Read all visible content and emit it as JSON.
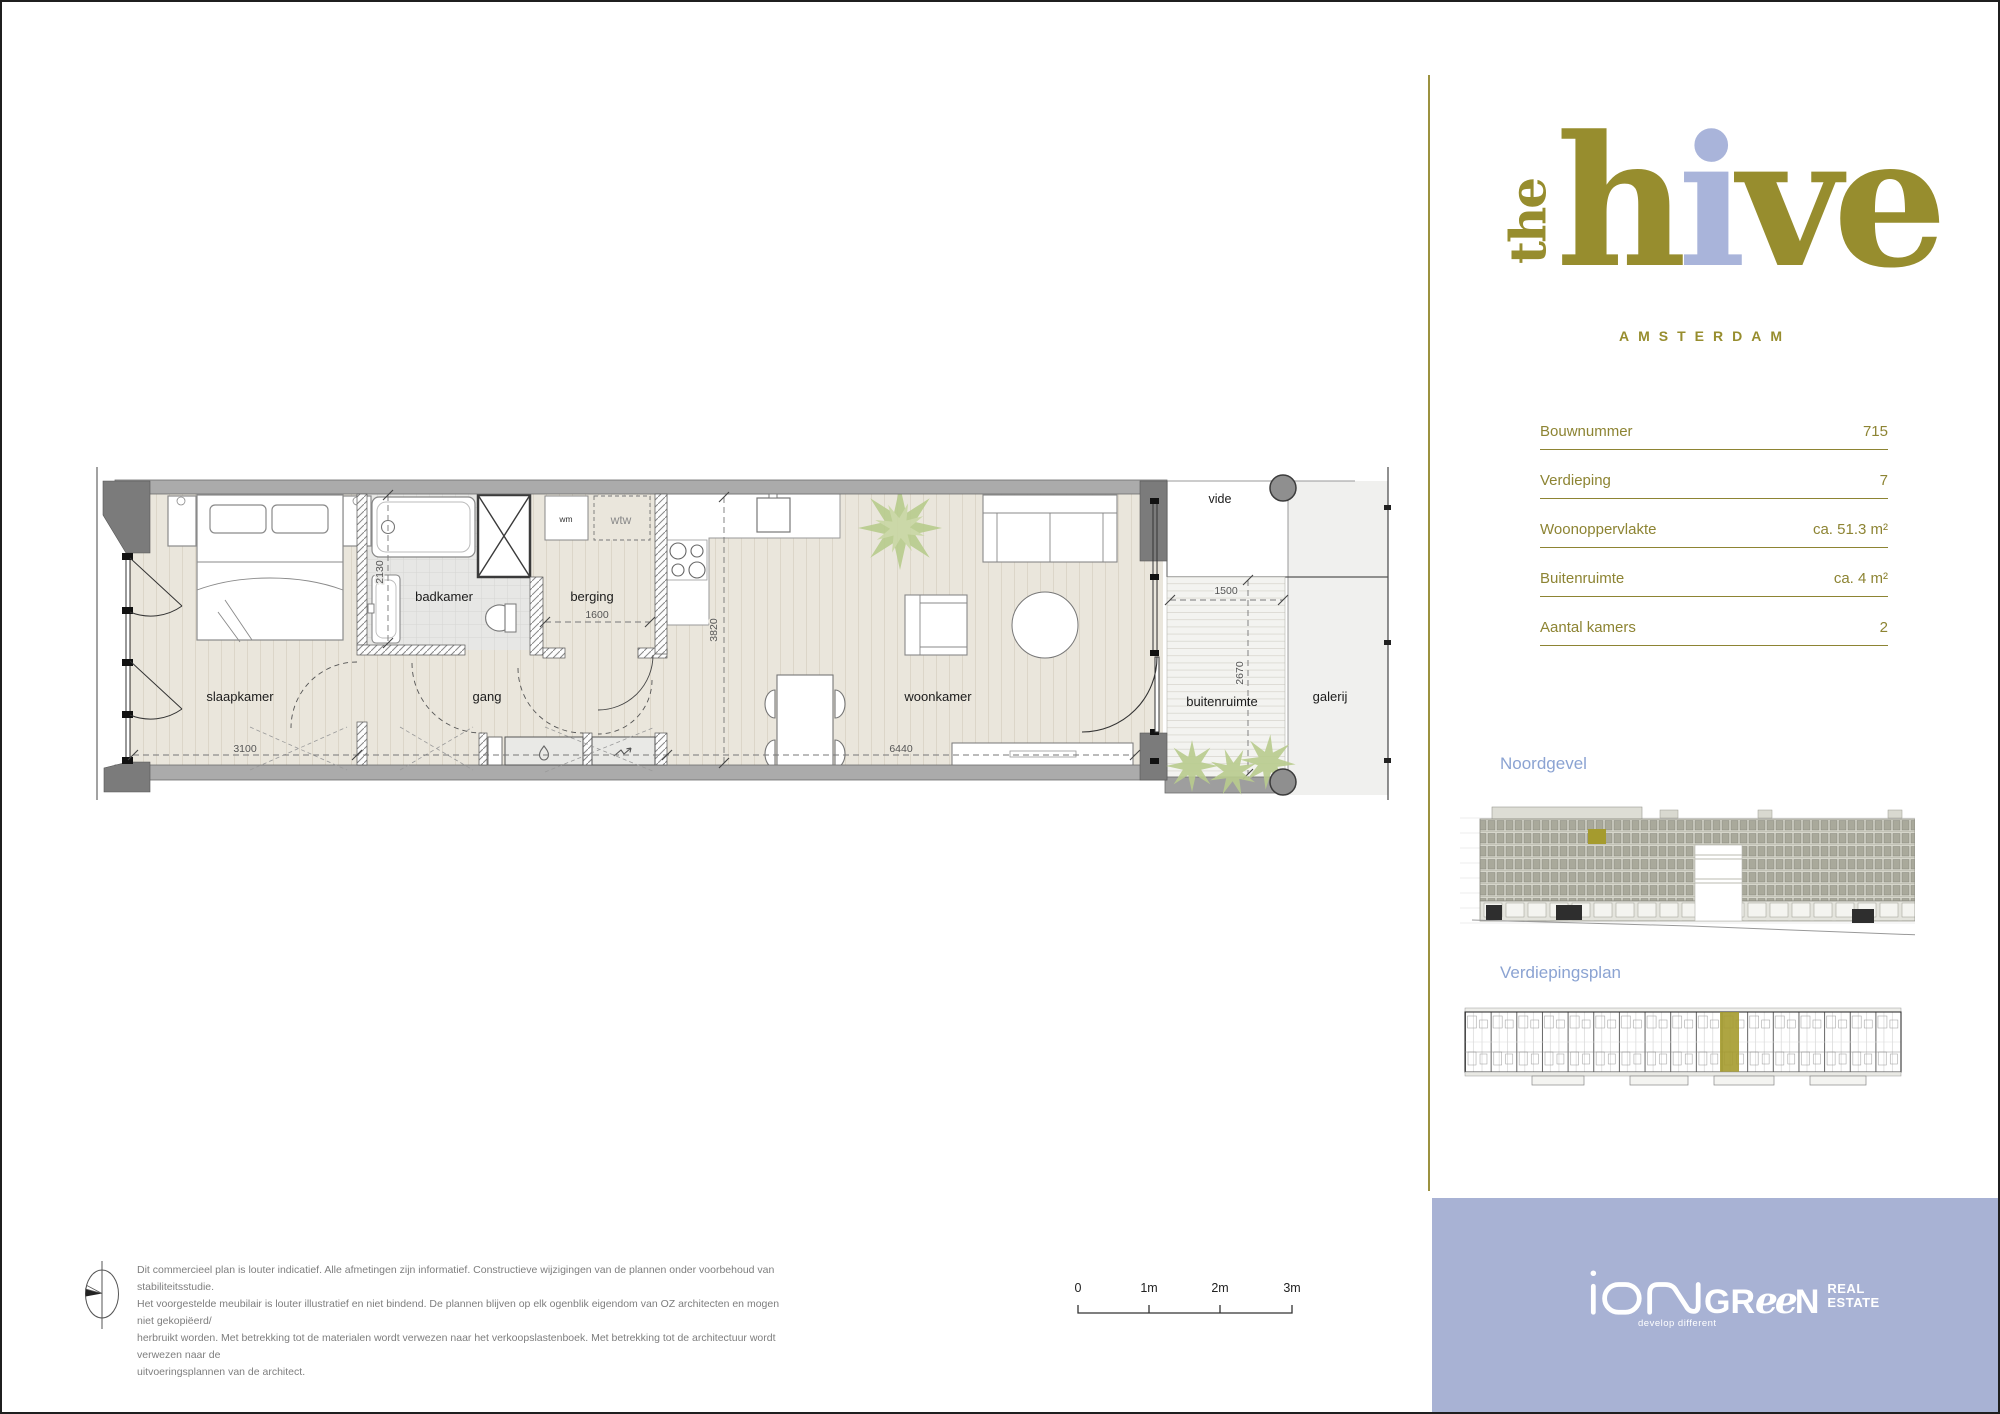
{
  "sidebar": {
    "logo": {
      "the": "the",
      "h": "h",
      "i": "i",
      "ve": "ve",
      "city": "AMSTERDAM"
    },
    "details": [
      {
        "label": "Bouwnummer",
        "value": "715"
      },
      {
        "label": "Verdieping",
        "value": "7"
      },
      {
        "label": "Woonoppervlakte",
        "value": "ca. 51.3 m²"
      },
      {
        "label": "Buitenruimte",
        "value": "ca. 4 m²"
      },
      {
        "label": "Aantal kamers",
        "value": "2"
      }
    ],
    "sections": {
      "elevation": "Noordgevel",
      "floorplan": "Verdiepingsplan"
    }
  },
  "plan": {
    "rooms": {
      "slaapkamer": "slaapkamer",
      "badkamer": "badkamer",
      "berging": "berging",
      "gang": "gang",
      "woonkamer": "woonkamer",
      "buitenruimte": "buitenruimte",
      "galerij": "galerij",
      "vide": "vide"
    },
    "appliances": {
      "wm": "wm",
      "wtw": "wtw"
    },
    "dims": {
      "slaapkamer_breedte": "3100",
      "badkamer_diepte": "2130",
      "berging_breedte": "1600",
      "woonkamer_diepte": "3820",
      "woonkamer_breedte": "6440",
      "buitenruimte_breedte": "1500",
      "buitenruimte_diepte": "2670"
    }
  },
  "footer": {
    "disclaimer_lines": [
      "Dit commercieel plan is louter indicatief. Alle afmetingen zijn informatief. Constructieve wijzigingen van de plannen onder voorbehoud van stabiliteitsstudie.",
      "Het voorgestelde meubilair is louter illustratief en niet bindend. De plannen blijven op elk ogenblik eigendom van OZ architecten en mogen niet gekopiëerd/",
      "herbruikt worden. Met betrekking tot de materialen wordt verwezen naar het verkoopslastenboek. Met betrekking tot de architectuur wordt verwezen naar de",
      "uitvoeringsplannen van de architect."
    ],
    "scale_ticks": [
      "0",
      "1m",
      "2m",
      "3m"
    ],
    "logos": {
      "ion_tagline": "develop different",
      "green_gr": "GR",
      "green_ee": "ee",
      "green_n": "N",
      "green_real": "REAL",
      "green_estate": "ESTATE"
    }
  },
  "colors": {
    "olive": "#978d2e",
    "lavender": "#a8b2d4",
    "periwinkle": "#8ba3d2",
    "highlight": "#a59b2e"
  }
}
